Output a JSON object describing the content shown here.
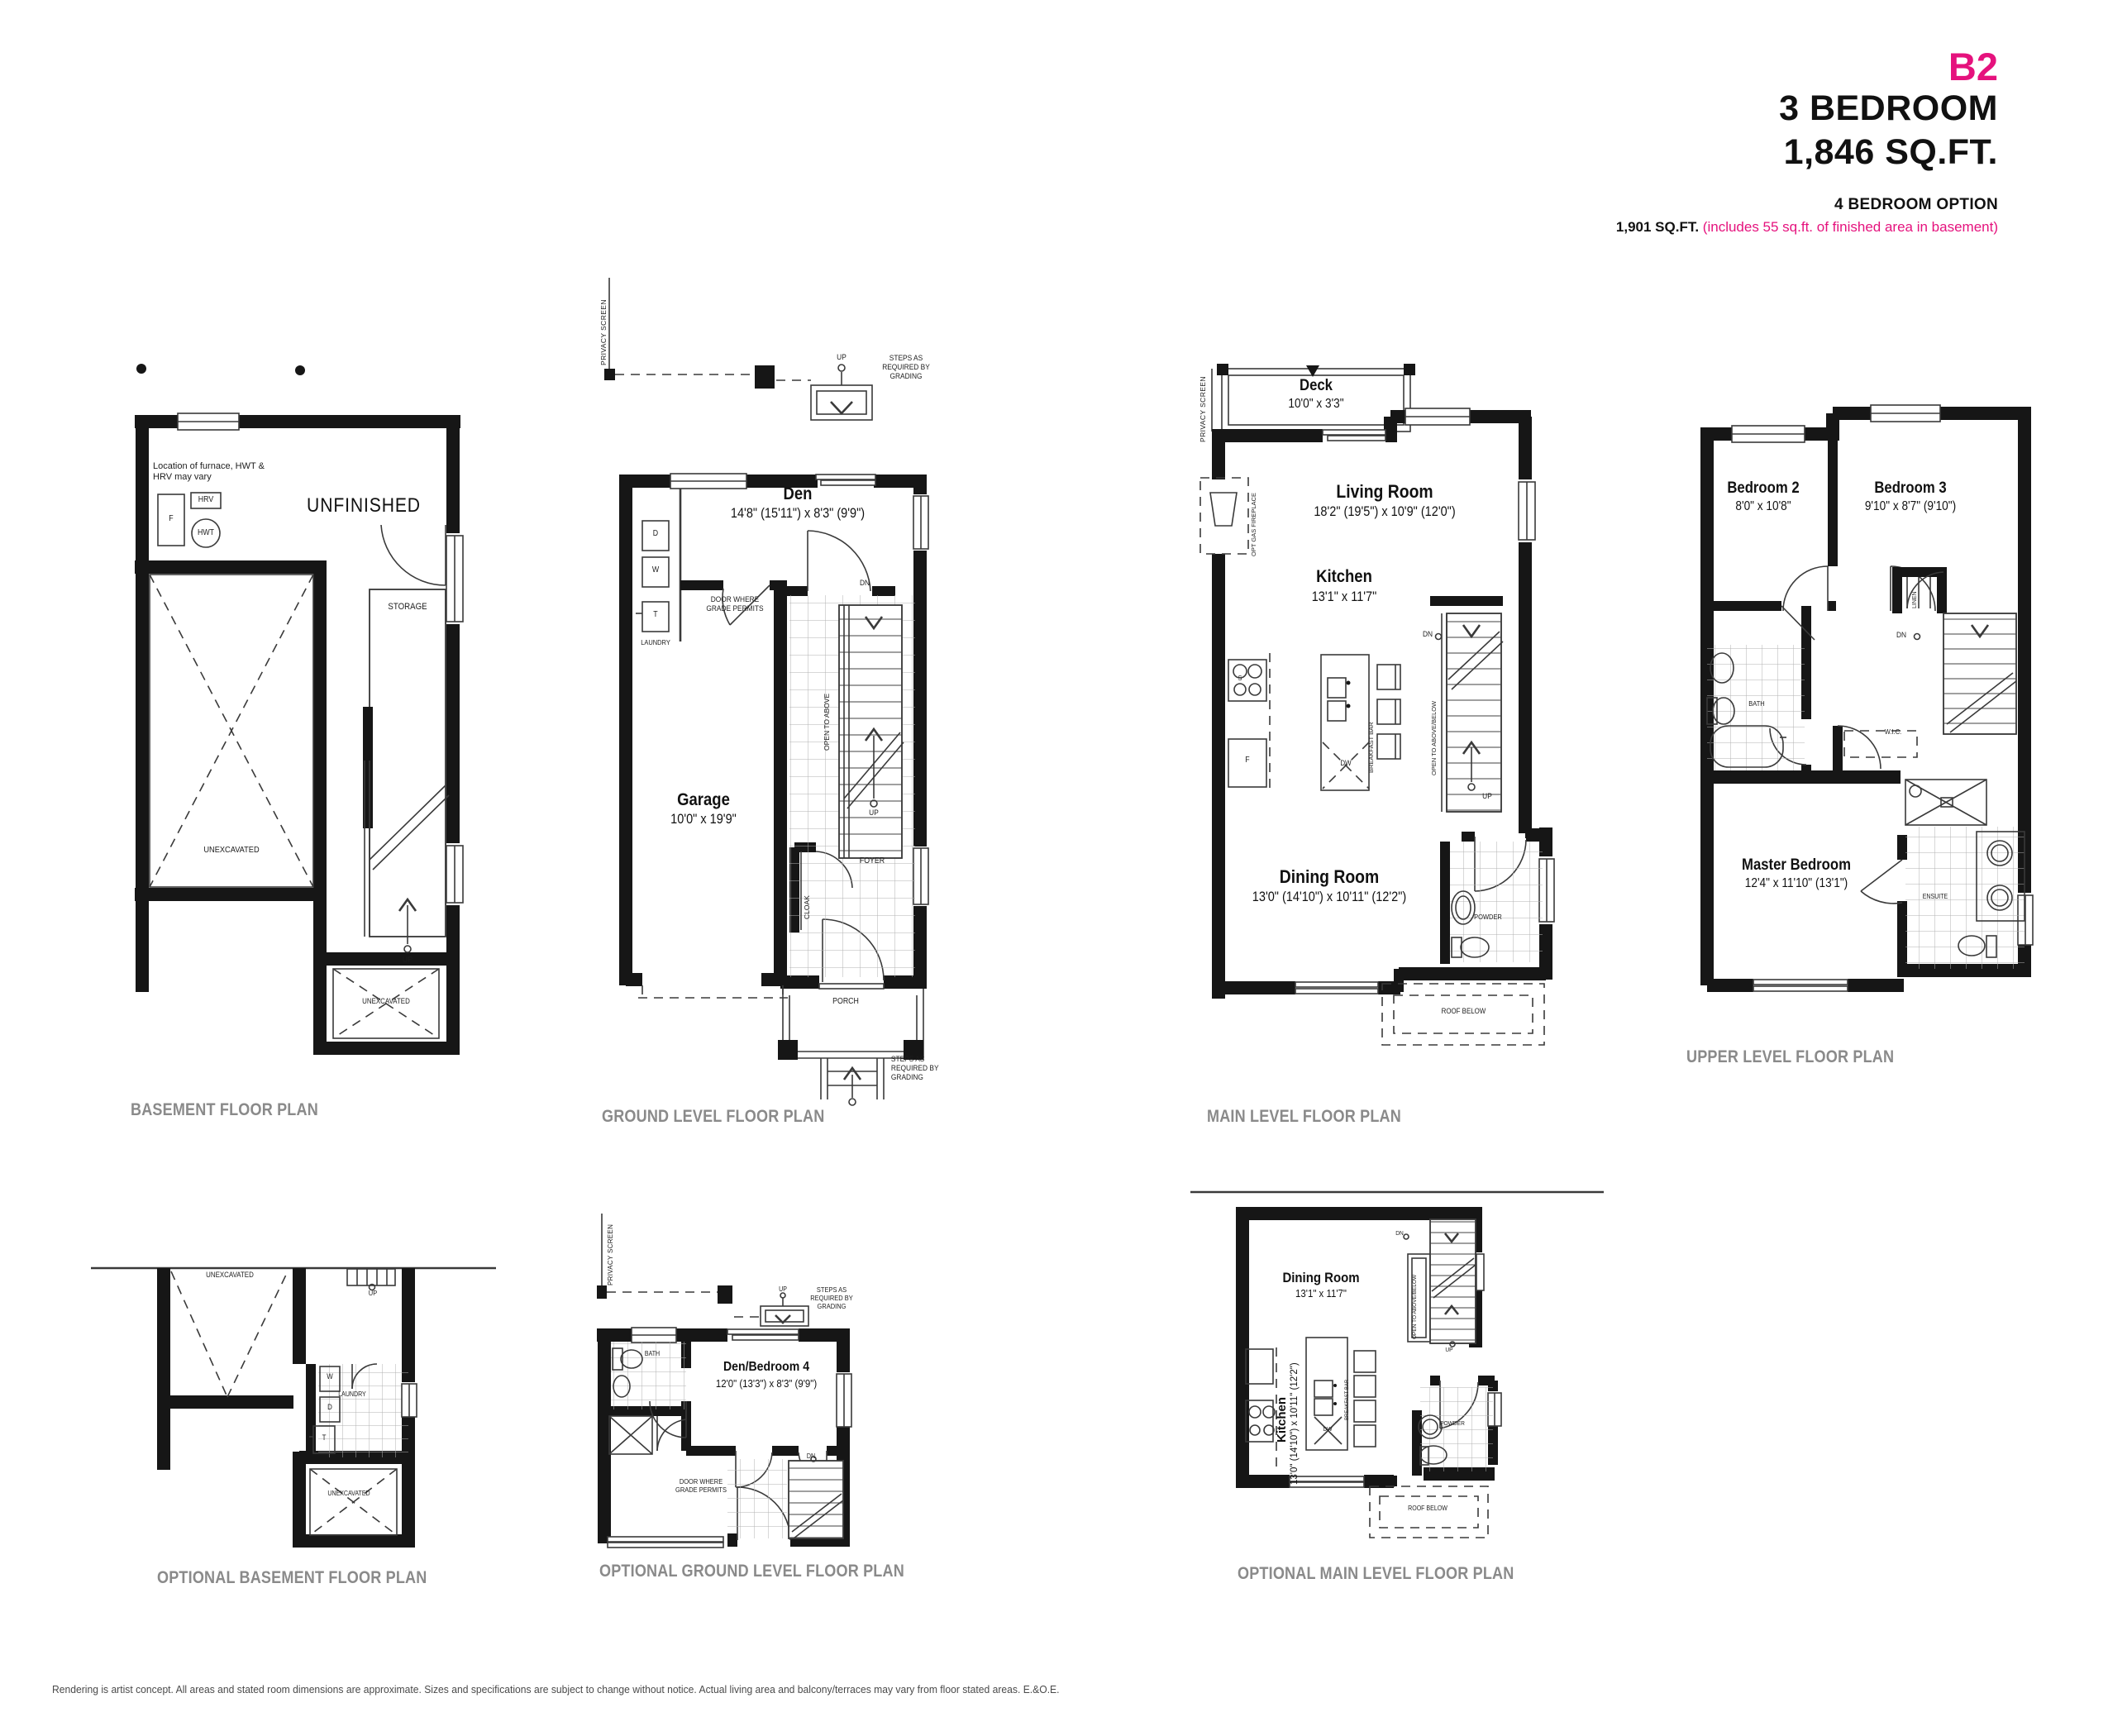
{
  "header": {
    "model_code": "B2",
    "bedrooms": "3 BEDROOM",
    "area": "1,846 SQ.FT.",
    "option_title": "4 BEDROOM OPTION",
    "option_area": "1,901 SQ.FT.",
    "option_note": "(includes 55 sq.ft. of finished area in basement)",
    "accent_color": "#E5127D"
  },
  "labels": {
    "up": "UP",
    "dn": "DN",
    "unexcavated": "UNEXCAVATED",
    "unfinished": "UNFINISHED",
    "storage": "STORAGE",
    "steps_grading": "STEPS AS REQUIRED BY GRADING",
    "privacy_screen": "PRIVACY SCREEN",
    "door_grade": "DOOR WHERE GRADE PERMITS",
    "open_above": "OPEN TO ABOVE",
    "open_above_below": "OPEN TO ABOVE/BELOW",
    "breakfast_bar": "BREAKFAST BAR",
    "roof_below": "ROOF BELOW",
    "powder": "POWDER",
    "laundry": "LAUNDRY",
    "foyer": "FOYER",
    "cloak": "CLOAK",
    "porch": "PORCH",
    "bath": "BATH",
    "wic": "W.I.C.",
    "linen": "LINEN",
    "ensuite": "ENSUITE",
    "w": "W",
    "d": "D",
    "t": "T",
    "f": "F",
    "s": "S",
    "dw": "DW",
    "hrv": "HRV",
    "hwt": "HWT",
    "furnace_note": "Location of furnace, HWT & HRV may vary"
  },
  "plans": {
    "basement": {
      "title": "BASEMENT FLOOR PLAN"
    },
    "ground": {
      "title": "GROUND LEVEL FLOOR PLAN",
      "den": {
        "name": "Den",
        "dims": "14'8\" (15'11\") x 8'3\" (9'9\")"
      },
      "garage": {
        "name": "Garage",
        "dims": "10'0\" x 19'9\""
      }
    },
    "main": {
      "title": "MAIN LEVEL FLOOR PLAN",
      "deck": {
        "name": "Deck",
        "dims": "10'0\" x 3'3\""
      },
      "living": {
        "name": "Living Room",
        "dims": "18'2\" (19'5\") x 10'9\" (12'0\")"
      },
      "kitchen": {
        "name": "Kitchen",
        "dims": "13'1\" x 11'7\""
      },
      "dining": {
        "name": "Dining Room",
        "dims": "13'0\" (14'10\") x 10'11\" (12'2\")"
      },
      "fireplace": "OPT GAS FIREPLACE"
    },
    "upper": {
      "title": "UPPER LEVEL FLOOR PLAN",
      "bedroom2": {
        "name": "Bedroom 2",
        "dims": "8'0\" x 10'8\""
      },
      "bedroom3": {
        "name": "Bedroom 3",
        "dims": "9'10\" x 8'7\" (9'10\")"
      },
      "master": {
        "name": "Master Bedroom",
        "dims": "12'4\" x 11'10\" (13'1\")"
      }
    },
    "opt_basement": {
      "title": "OPTIONAL BASEMENT FLOOR PLAN"
    },
    "opt_ground": {
      "title": "OPTIONAL GROUND LEVEL FLOOR PLAN",
      "den4": {
        "name": "Den/Bedroom 4",
        "dims": "12'0\" (13'3\") x 8'3\" (9'9\")"
      }
    },
    "opt_main": {
      "title": "OPTIONAL MAIN LEVEL FLOOR PLAN",
      "dining": {
        "name": "Dining Room",
        "dims": "13'1\" x 11'7\""
      },
      "kitchen": {
        "name": "Kitchen",
        "dims": "13'0\" (14'10\") x 10'11\" (12'2\")"
      }
    }
  },
  "footer": {
    "disclaimer": "Rendering is artist concept. All areas and stated room dimensions are approximate. Sizes and specifications are subject to change without notice. Actual living area and balcony/terraces may vary from floor stated areas. E.&O.E."
  }
}
